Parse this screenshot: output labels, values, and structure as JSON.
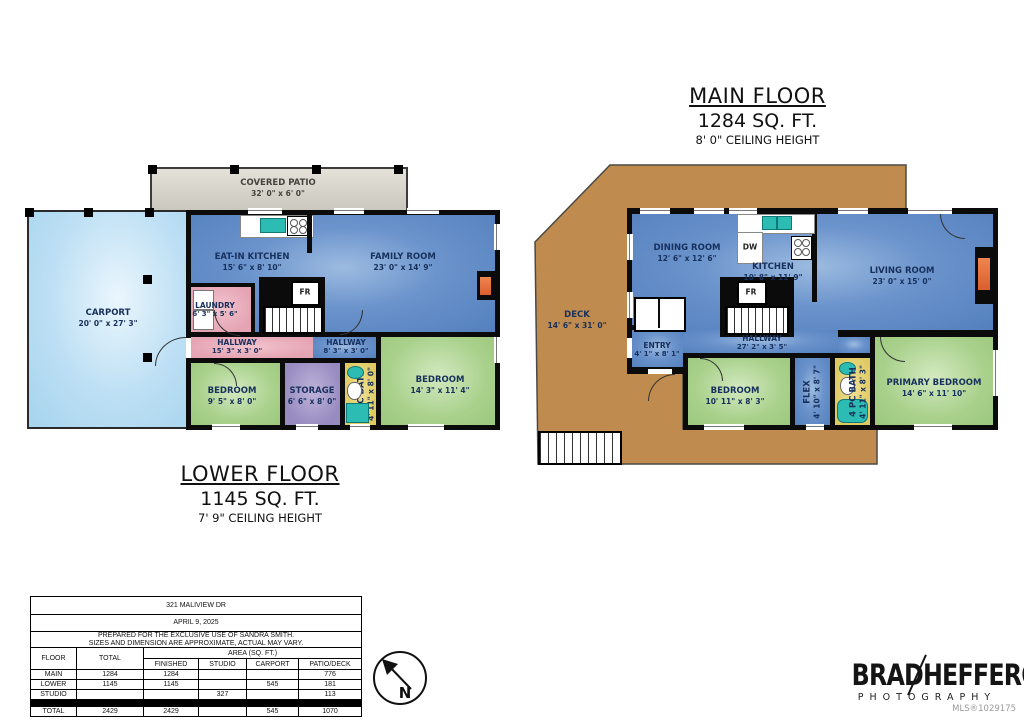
{
  "titles": {
    "main": {
      "title": "MAIN FLOOR",
      "sqft": "1284 SQ. FT.",
      "ceiling": "8' 0\" CEILING HEIGHT"
    },
    "lower": {
      "title": "LOWER FLOOR",
      "sqft": "1145 SQ. FT.",
      "ceiling": "7' 9\" CEILING HEIGHT"
    }
  },
  "main_floor": {
    "deck": {
      "name": "DECK",
      "dims": "14' 6\" x 31' 0\""
    },
    "dining_room": {
      "name": "DINING ROOM",
      "dims": "12' 6\" x 12' 6\""
    },
    "kitchen": {
      "name": "KITCHEN",
      "dims": "10' 8\" x 11' 9\""
    },
    "living_room": {
      "name": "LIVING ROOM",
      "dims": "23' 0\" x 15' 0\""
    },
    "entry": {
      "name": "ENTRY",
      "dims": "4' 1\" x 8' 1\""
    },
    "hallway": {
      "name": "HALLWAY",
      "dims": "27' 2\" x 3' 5\""
    },
    "bedroom": {
      "name": "BEDROOM",
      "dims": "10' 11\" x 8' 3\""
    },
    "flex": {
      "name": "FLEX",
      "dims": "4' 10\" x 8' 7\""
    },
    "bath": {
      "name": "4 PC BATH",
      "dims": "4' 11\" x 8' 3\""
    },
    "primary_bedroom": {
      "name": "PRIMARY BEDROOM",
      "dims": "14' 6\" x 11' 10\""
    },
    "dw_label": "DW",
    "fr_label": "FR"
  },
  "lower_floor": {
    "covered_patio": {
      "name": "COVERED PATIO",
      "dims": "32' 0\" x 6' 0\""
    },
    "carport": {
      "name": "CARPORT",
      "dims": "20' 0\" x 27' 3\""
    },
    "eat_in_kitchen": {
      "name": "EAT-IN KITCHEN",
      "dims": "15' 6\" x 8' 10\""
    },
    "family_room": {
      "name": "FAMILY ROOM",
      "dims": "23' 0\" x 14' 9\""
    },
    "laundry": {
      "name": "LAUNDRY",
      "dims": "6' 3\" x 5' 6\""
    },
    "hallway_a": {
      "name": "HALLWAY",
      "dims": "15' 3\" x 3' 0\""
    },
    "hallway_b": {
      "name": "HALLWAY",
      "dims": "8' 3\" x 3' 0\""
    },
    "bedroom_a": {
      "name": "BEDROOM",
      "dims": "9' 5\" x 8' 0\""
    },
    "storage": {
      "name": "STORAGE",
      "dims": "6' 6\" x 8' 0\""
    },
    "bath": {
      "name": "3 PC BATH",
      "dims": "4' 11\" x 8' 0\""
    },
    "bedroom_b": {
      "name": "BEDROOM",
      "dims": "14' 3\" x 11' 4\""
    },
    "fr_label": "FR"
  },
  "info_table": {
    "address": "321 MALIVIEW DR",
    "date": "APRIL 9, 2025",
    "disclaimer1": "PREPARED FOR THE EXCLUSIVE USE OF SANDRA SMITH.",
    "disclaimer2": "SIZES AND DIMENSION ARE APPROXIMATE, ACTUAL MAY VARY.",
    "headers": {
      "floor": "FLOOR",
      "total": "TOTAL",
      "area": "AREA (SQ. FT.)",
      "finished": "FINISHED",
      "studio": "STUDIO",
      "carport": "CARPORT",
      "patio_deck": "PATIO/DECK"
    },
    "rows": [
      {
        "floor": "MAIN",
        "total": "1284",
        "finished": "1284",
        "studio": "",
        "carport": "",
        "patio_deck": "776"
      },
      {
        "floor": "LOWER",
        "total": "1145",
        "finished": "1145",
        "studio": "",
        "carport": "545",
        "patio_deck": "181"
      },
      {
        "floor": "STUDIO",
        "total": "",
        "finished": "",
        "studio": "327",
        "carport": "",
        "patio_deck": "113"
      }
    ],
    "total_row": {
      "floor": "TOTAL",
      "total": "2429",
      "finished": "2429",
      "studio": "",
      "carport": "545",
      "patio_deck": "1070"
    }
  },
  "compass": {
    "north": "N"
  },
  "logo": {
    "part1": "BRAD",
    "part2": "HEFFERON",
    "subtitle": "PHOTOGRAPHY",
    "mls": "MLS®1029175"
  },
  "colors": {
    "room_blue": "#5b86c3",
    "room_green": "#a5cf8a",
    "room_pink": "#e7a9b7",
    "room_purple": "#9a8dc2",
    "room_yellow": "#e5d06e",
    "carport_blue": "#b3d9f2",
    "deck_brown": "#c08b4f",
    "patio_gray": "#d8d5cc",
    "fixture_teal": "#2cbcb4",
    "fireplace_orange": "#e06a3a"
  }
}
